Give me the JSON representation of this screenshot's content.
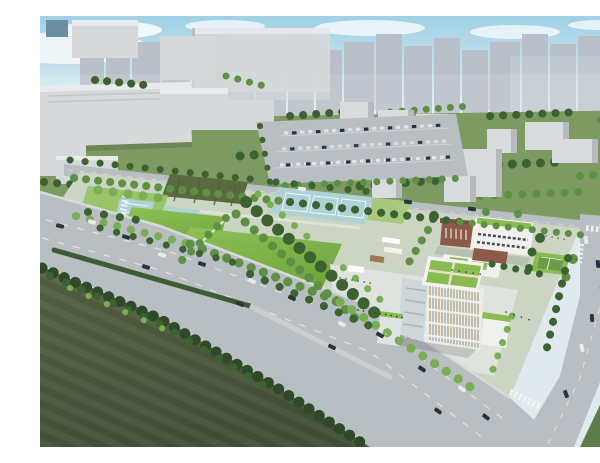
{
  "meta": {
    "title": "Aerial rendering — school campus and sports park master plan",
    "description": "Bird's-eye architectural rendering of a planned campus: green-roofed school buildings, a great lawn, tennis and multi-sport courts, a tree-lined boulevard with traffic, surface parking, dark farmland in the foreground and a high-rise city skyline on the horizon."
  },
  "scene": {
    "regions": [
      {
        "name": "sky",
        "label": "Hazy blue sky with clouds"
      },
      {
        "name": "city-skyline",
        "label": "High-rise apartment towers on the horizon"
      },
      {
        "name": "industrial-warehouses",
        "label": "Gray industrial buildings, upper left"
      },
      {
        "name": "midground-park",
        "label": "Green blocks with low-rise buildings and tree clusters"
      },
      {
        "name": "parking-lot",
        "label": "Surface parking lot with parked cars"
      },
      {
        "name": "perimeter-street",
        "label": "Street along the top edge of the site"
      },
      {
        "name": "planted-field",
        "label": "Dark planted field plot"
      },
      {
        "name": "sport-courts",
        "label": "Small light-blue multi-sport courts"
      },
      {
        "name": "tennis-courts",
        "label": "Three light-blue tennis courts"
      },
      {
        "name": "great-lawn",
        "label": "Large open lawn"
      },
      {
        "name": "tree-promenade",
        "label": "Diagonal tree-lined promenade"
      },
      {
        "name": "school-brick-building",
        "label": "Brick school wing with roof terrace"
      },
      {
        "name": "school-white-building",
        "label": "White school wing with green roof"
      },
      {
        "name": "main-building",
        "label": "Main building with rooftop garden quadrants"
      },
      {
        "name": "campus-plaza",
        "label": "Paved plaza with pergolas and people"
      },
      {
        "name": "green-court",
        "label": "Green practice court"
      },
      {
        "name": "boulevard",
        "label": "Wide tree-lined boulevard with traffic and hedge median"
      },
      {
        "name": "side-road",
        "label": "Side road with crosswalks and intersection"
      },
      {
        "name": "farmland",
        "label": "Dark farmland in the foreground"
      },
      {
        "name": "roadside-trees",
        "label": "Dense tree row along the farmland edge"
      }
    ]
  },
  "colors": {
    "sky": "#9fd0e4",
    "skyHaze": "#edf3f5",
    "water": "#84c6d3",
    "tower": "#b9bec6",
    "towerLight": "#ced3d9",
    "building": "#d6d8d9",
    "parkGreen": "#7d9a62",
    "lawn": "#8fc258",
    "lawnDeep": "#72a73f",
    "field": "#5a6a40",
    "farm": "#46523a",
    "farmLight": "#596545",
    "teal": "#aed2d6",
    "road": "#b9bec3",
    "roadLight": "#c9cdd1",
    "treeDark": "#3c6231",
    "tree": "#5d9044",
    "treeLight": "#7aae55",
    "brick": "#8d5a49",
    "greenRoof": "#8abb50",
    "whiteBldg": "#f0f1ef",
    "plaza": "#dee3dd",
    "carDark": "#2a3340",
    "carWhite": "#e8eaec"
  }
}
